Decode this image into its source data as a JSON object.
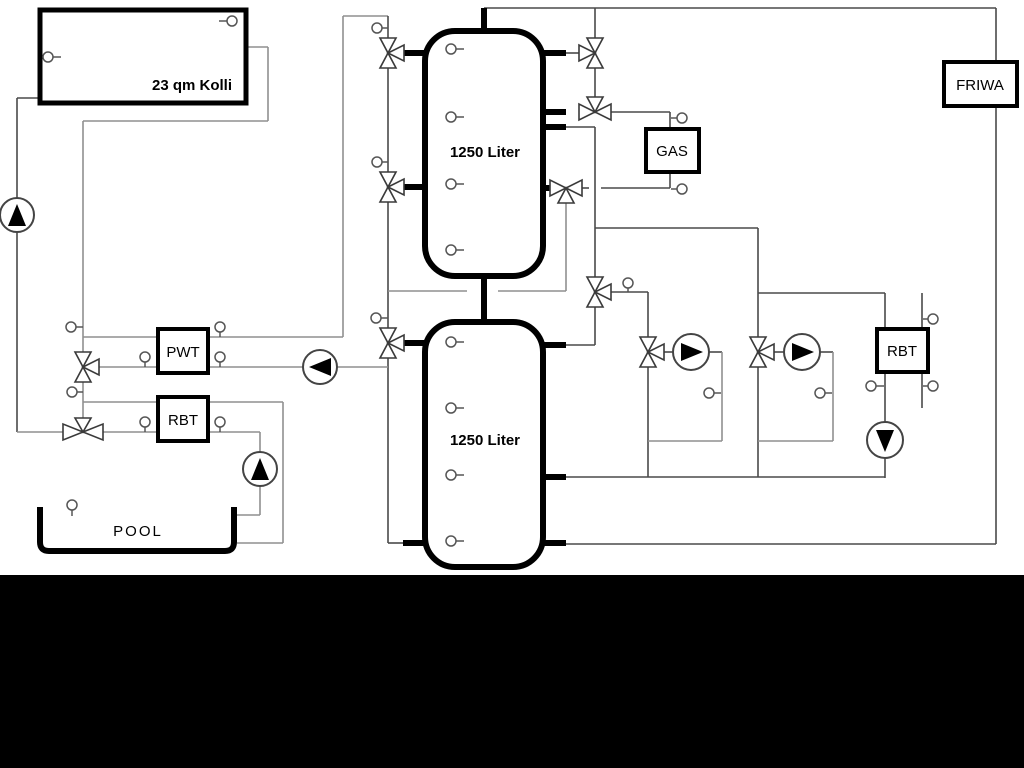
{
  "page": {
    "background": "#ffffff",
    "footer_bar_color": "#000000"
  },
  "diagram": {
    "type": "hydraulic-heating-schematic",
    "components": {
      "collector": {
        "label": "23 qm Kolli"
      },
      "buffer_tank_top": {
        "label": "1250 Liter"
      },
      "buffer_tank_bottom": {
        "label": "1250 Liter"
      },
      "gas_boiler": {
        "label": "GAS"
      },
      "fresh_water_station": {
        "label": "FRIWA"
      },
      "heat_exchanger_pwt": {
        "label": "PWT"
      },
      "heat_exchanger_rbt_left": {
        "label": "RBT"
      },
      "heat_exchanger_rbt_right": {
        "label": "RBT"
      },
      "pool": {
        "label": "POOL"
      }
    },
    "colors": {
      "line_dark": "#4a4a4a",
      "line_gray": "#8f8f8f",
      "pipe_black": "#000000",
      "symbol_fill": "#ffffff"
    }
  }
}
